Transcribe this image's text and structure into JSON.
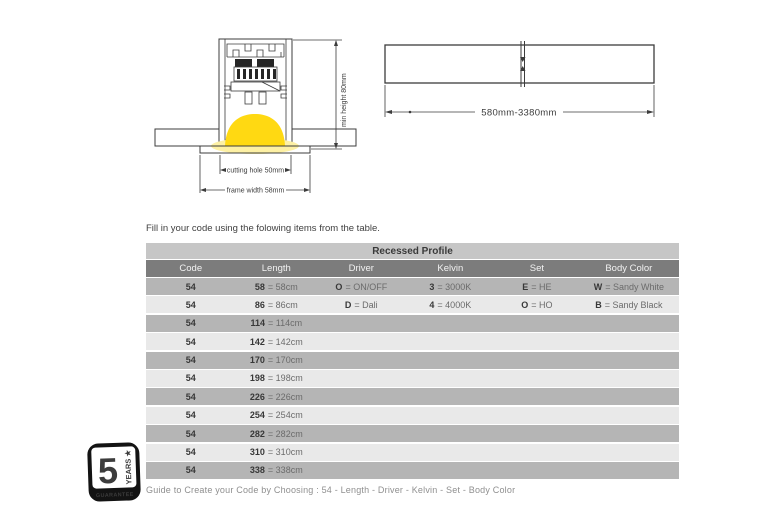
{
  "cross_section": {
    "min_height_label": "min height 80mm",
    "cutting_hole_label": "cutting hole 50mm",
    "frame_width_label": "frame width 58mm"
  },
  "length_diagram": {
    "range_label": "580mm-3380mm"
  },
  "intro_text": "Fill in your code using the folowing items from the table.",
  "table": {
    "title": "Recessed Profile",
    "columns": [
      "Code",
      "Length",
      "Driver",
      "Kelvin",
      "Set",
      "Body Color"
    ],
    "rows": [
      [
        [
          "54",
          ""
        ],
        [
          "58",
          "= 58cm"
        ],
        [
          "O",
          "= ON/OFF"
        ],
        [
          "3",
          "= 3000K"
        ],
        [
          "E",
          "= HE"
        ],
        [
          "W",
          "= Sandy White"
        ]
      ],
      [
        [
          "54",
          ""
        ],
        [
          "86",
          "= 86cm"
        ],
        [
          "D",
          "= Dali"
        ],
        [
          "4",
          "= 4000K"
        ],
        [
          "O",
          "= HO"
        ],
        [
          "B",
          "= Sandy Black"
        ]
      ],
      [
        [
          "54",
          ""
        ],
        [
          "114",
          "= 114cm"
        ],
        [
          "",
          ""
        ],
        [
          "",
          ""
        ],
        [
          "",
          ""
        ],
        [
          "",
          ""
        ]
      ],
      [
        [
          "54",
          ""
        ],
        [
          "142",
          "= 142cm"
        ],
        [
          "",
          ""
        ],
        [
          "",
          ""
        ],
        [
          "",
          ""
        ],
        [
          "",
          ""
        ]
      ],
      [
        [
          "54",
          ""
        ],
        [
          "170",
          "= 170cm"
        ],
        [
          "",
          ""
        ],
        [
          "",
          ""
        ],
        [
          "",
          ""
        ],
        [
          "",
          ""
        ]
      ],
      [
        [
          "54",
          ""
        ],
        [
          "198",
          "= 198cm"
        ],
        [
          "",
          ""
        ],
        [
          "",
          ""
        ],
        [
          "",
          ""
        ],
        [
          "",
          ""
        ]
      ],
      [
        [
          "54",
          ""
        ],
        [
          "226",
          "= 226cm"
        ],
        [
          "",
          ""
        ],
        [
          "",
          ""
        ],
        [
          "",
          ""
        ],
        [
          "",
          ""
        ]
      ],
      [
        [
          "54",
          ""
        ],
        [
          "254",
          "= 254cm"
        ],
        [
          "",
          ""
        ],
        [
          "",
          ""
        ],
        [
          "",
          ""
        ],
        [
          "",
          ""
        ]
      ],
      [
        [
          "54",
          ""
        ],
        [
          "282",
          "= 282cm"
        ],
        [
          "",
          ""
        ],
        [
          "",
          ""
        ],
        [
          "",
          ""
        ],
        [
          "",
          ""
        ]
      ],
      [
        [
          "54",
          ""
        ],
        [
          "310",
          "= 310cm"
        ],
        [
          "",
          ""
        ],
        [
          "",
          ""
        ],
        [
          "",
          ""
        ],
        [
          "",
          ""
        ]
      ],
      [
        [
          "54",
          ""
        ],
        [
          "338",
          "= 338cm"
        ],
        [
          "",
          ""
        ],
        [
          "",
          ""
        ],
        [
          "",
          ""
        ],
        [
          "",
          ""
        ]
      ]
    ],
    "colors": {
      "title_bg": "#c6c6c6",
      "header_bg": "#7c7c7c",
      "row_dark_bg": "#b5b5b5",
      "row_light_bg": "#e9e9e9"
    }
  },
  "badge": {
    "number": "5",
    "years_label": "YEARS ★",
    "guarantee_label": "GUARANTEE"
  },
  "footer_text": "Guide to Create your Code by Choosing : 54 - Length - Driver - Kelvin - Set - Body Color",
  "highlight_color": "#ffd912"
}
